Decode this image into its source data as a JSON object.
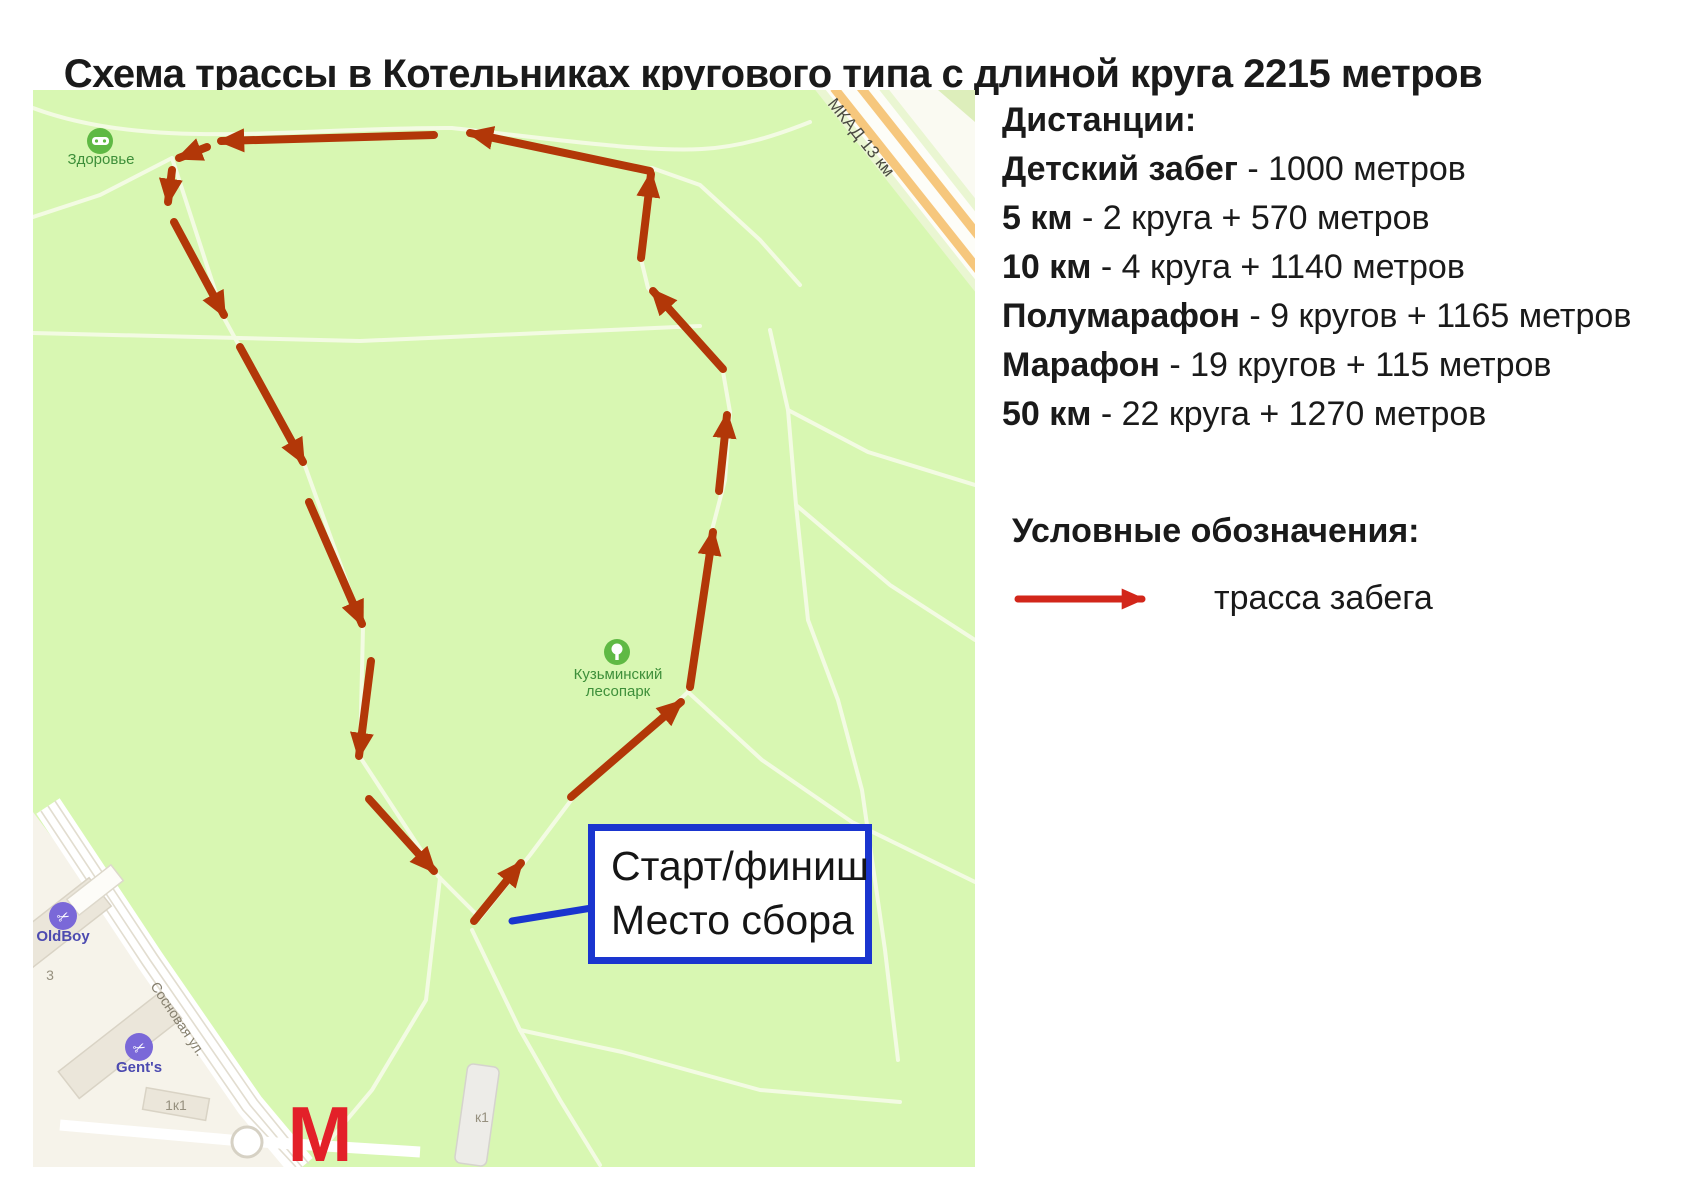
{
  "title": "Схема трассы в Котельниках кругового типа с длиной круга 2215 метров",
  "distances": {
    "heading": "Дистанции:",
    "items": [
      {
        "name": "Детский забег",
        "value": " - 1000 метров"
      },
      {
        "name": "5 км",
        "value": " - 2 круга + 570 метров"
      },
      {
        "name": "10 км",
        "value": " - 4 круга + 1140 метров"
      },
      {
        "name": "Полумарафон",
        "value": " - 9 кругов + 1165 метров"
      },
      {
        "name": "Марафон",
        "value": " - 19 кругов + 115 метров"
      },
      {
        "name": "50 км",
        "value": " - 22 круга + 1270 метров"
      }
    ]
  },
  "legend": {
    "heading": "Условные обозначения:",
    "item_label": "трасса забега"
  },
  "start_box": {
    "line1": "Старт/финиш",
    "line2": "Место сбора"
  },
  "map": {
    "labels": {
      "zdorovye": "Здоровье",
      "lesopark_line1": "Кузьминский",
      "lesopark_line2": "лесопарк",
      "mkad": "МКАД 13 км",
      "oldboy": "OldBoy",
      "gents": "Gent's",
      "street": "Сосновая ул.",
      "building3": "3",
      "building1k1": "1к1",
      "buildingk1": "к1",
      "metro": "М"
    },
    "route": {
      "arrows": [
        [
          650,
          171,
          470,
          133
        ],
        [
          434,
          135,
          221,
          141
        ],
        [
          207,
          147,
          179,
          158
        ],
        [
          172,
          170,
          168,
          202
        ],
        [
          174,
          222,
          224,
          315
        ],
        [
          240,
          347,
          303,
          462
        ],
        [
          309,
          502,
          362,
          624
        ],
        [
          371,
          661,
          359,
          756
        ],
        [
          369,
          799,
          434,
          871
        ],
        [
          474,
          921,
          521,
          863
        ],
        [
          571,
          797,
          681,
          702
        ],
        [
          690,
          687,
          713,
          532
        ],
        [
          719,
          491,
          727,
          415
        ],
        [
          723,
          369,
          653,
          291
        ],
        [
          641,
          258,
          651,
          174
        ]
      ]
    },
    "colors": {
      "park_green": "#d8f7b2",
      "route_arrow": "#b23708",
      "legend_arrow": "#d2261a",
      "start_box_border": "#1a35cf",
      "pointer_blue": "#1a35cf",
      "metro_red": "#e32029",
      "poi_green": "#5fb944",
      "poi_purple": "#7a68d8",
      "mkad_orange": "#f6c77d"
    }
  }
}
